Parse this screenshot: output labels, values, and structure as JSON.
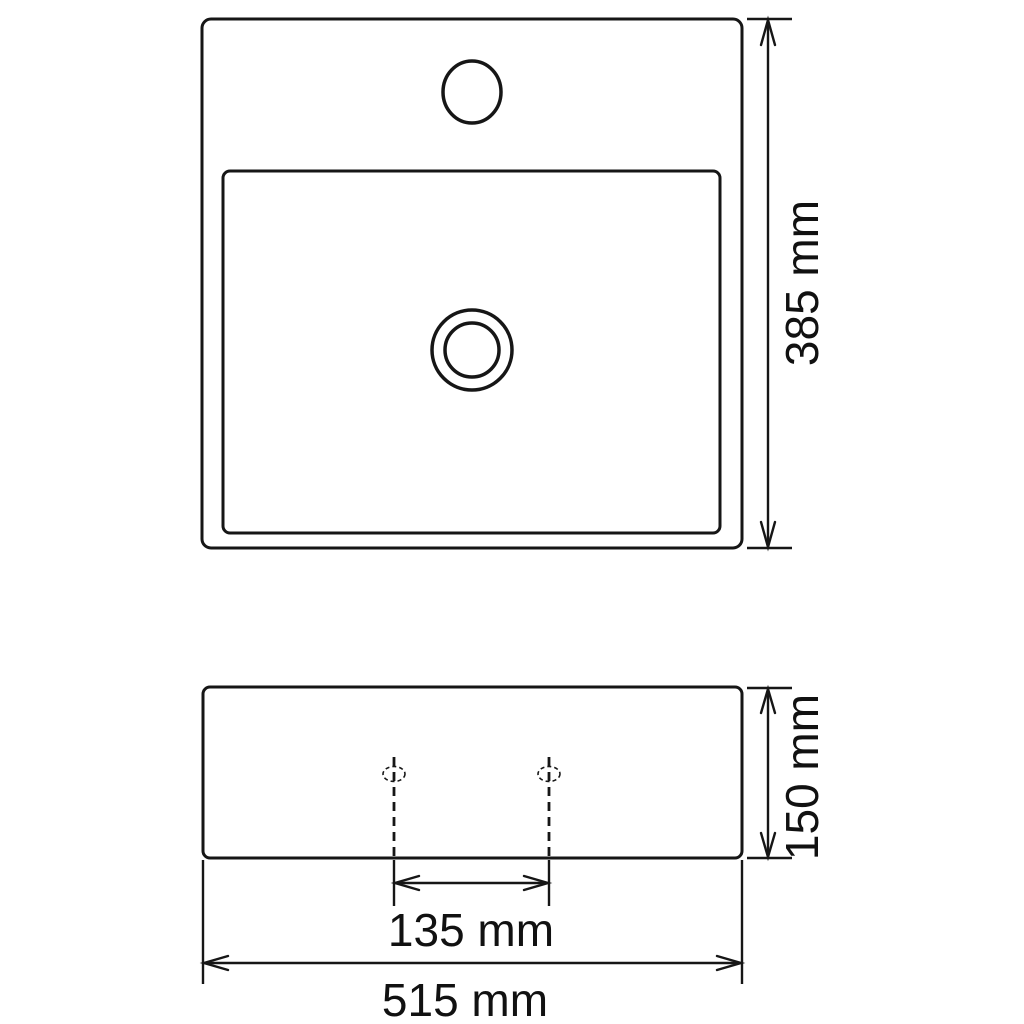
{
  "drawing": {
    "background_color": "#ffffff",
    "line_color": "#161616",
    "views": {
      "top_view": "top view of basin with faucet hole, inner bowl rim and drain",
      "front_view": "front view of basin with two dashed hole centerlines"
    },
    "dimensions": {
      "depth": {
        "label": "385 mm",
        "value": 385,
        "unit": "mm",
        "orientation": "vertical"
      },
      "thickness": {
        "label": "150 mm",
        "value": 150,
        "unit": "mm",
        "orientation": "vertical"
      },
      "hole_spacing": {
        "label": "135 mm",
        "value": 135,
        "unit": "mm",
        "orientation": "horizontal"
      },
      "width": {
        "label": "515 mm",
        "value": 515,
        "unit": "mm",
        "orientation": "horizontal"
      }
    }
  }
}
